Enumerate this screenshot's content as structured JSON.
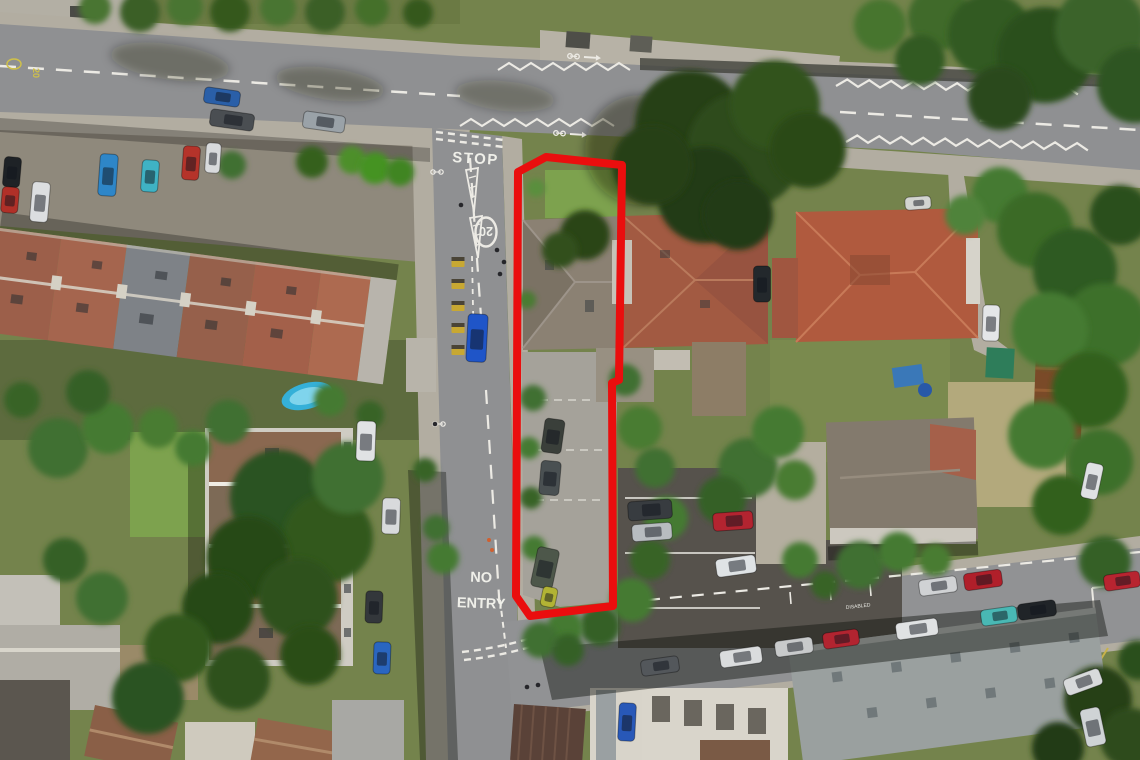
{
  "image": {
    "type": "aerial-drone-photo",
    "description": "Aerial view of a residential junction with a long narrow property plot outlined in red, containing a semi-detached house and rear parking area"
  },
  "boundary": {
    "label": "property-boundary",
    "color": "#ea0e0e",
    "stroke_width": 8,
    "points": "518,172 546,157 622,165 619,380 612,383 613,606 530,616 516,596"
  },
  "road_markings": {
    "stop": "STOP",
    "speed_limit": "20",
    "speed_limit_yellow": "20",
    "no_entry_line1": "NO",
    "no_entry_line2": "ENTRY",
    "disabled_bay": "DISABLED"
  },
  "palette": {
    "road": "#8f9092",
    "pavement": "#b2ada1",
    "grass": "#74834c",
    "dry_grass": "#b3a97c",
    "tree_dark": "#253f16",
    "tree_light": "#4a7c33",
    "roof_red": "#a25a42",
    "roof_grey": "#8b8173",
    "car_park_asphalt": "#56524c",
    "boundary_red": "#ea0e0e"
  },
  "trees": [
    [
      95,
      8,
      16,
      "#4a7530"
    ],
    [
      140,
      12,
      20,
      "#3a5f25"
    ],
    [
      185,
      7,
      18,
      "#4a7530"
    ],
    [
      230,
      12,
      20,
      "#35591f"
    ],
    [
      278,
      8,
      18,
      "#4a7530"
    ],
    [
      325,
      12,
      20,
      "#3a5f25"
    ],
    [
      372,
      9,
      17,
      "#44702c"
    ],
    [
      418,
      13,
      15,
      "#35591f"
    ],
    [
      232,
      165,
      14,
      "#3f7030"
    ],
    [
      312,
      162,
      16,
      "#35601f"
    ],
    [
      352,
      160,
      14,
      "#4d8f2a"
    ],
    [
      375,
      168,
      16,
      "#459323"
    ],
    [
      400,
      172,
      14,
      "#3f8524"
    ],
    [
      690,
      168,
      14,
      "#4a7c33"
    ],
    [
      718,
      172,
      15,
      "#3f7030"
    ],
    [
      748,
      174,
      13,
      "#447a32"
    ],
    [
      690,
      125,
      55,
      "#253f16"
    ],
    [
      745,
      150,
      58,
      "#2d4c1a"
    ],
    [
      705,
      195,
      48,
      "#223a14"
    ],
    [
      775,
      105,
      45,
      "#32531e"
    ],
    [
      652,
      165,
      40,
      "#253f16"
    ],
    [
      808,
      150,
      38,
      "#2b4819"
    ],
    [
      738,
      215,
      35,
      "#223a14"
    ],
    [
      940,
      18,
      32,
      "#3f6b2b"
    ],
    [
      990,
      35,
      42,
      "#335a22"
    ],
    [
      1045,
      55,
      48,
      "#2c4f1c"
    ],
    [
      1100,
      30,
      45,
      "#3a6329"
    ],
    [
      1135,
      85,
      38,
      "#2f5520"
    ],
    [
      880,
      25,
      26,
      "#47742f"
    ],
    [
      1000,
      98,
      32,
      "#2b4a1d"
    ],
    [
      920,
      60,
      25,
      "#335a22"
    ],
    [
      1000,
      195,
      28,
      "#447a32"
    ],
    [
      1035,
      230,
      38,
      "#3a6b28"
    ],
    [
      1075,
      270,
      42,
      "#2f5a20"
    ],
    [
      1105,
      325,
      42,
      "#3c7029"
    ],
    [
      1050,
      330,
      38,
      "#447a32"
    ],
    [
      1090,
      390,
      38,
      "#32601f"
    ],
    [
      1042,
      435,
      34,
      "#447a32"
    ],
    [
      1100,
      462,
      33,
      "#3c7029"
    ],
    [
      1062,
      505,
      30,
      "#32601f"
    ],
    [
      1120,
      215,
      30,
      "#2c4f1c"
    ],
    [
      965,
      215,
      20,
      "#50833a"
    ],
    [
      533,
      398,
      13,
      "#3f7030"
    ],
    [
      529,
      448,
      11,
      "#447a32"
    ],
    [
      531,
      498,
      11,
      "#386328"
    ],
    [
      534,
      548,
      12,
      "#447a32"
    ],
    [
      527,
      300,
      9,
      "#4a7c33"
    ],
    [
      536,
      188,
      9,
      "#5a8f3c"
    ],
    [
      585,
      235,
      25,
      "#2c4418"
    ],
    [
      560,
      250,
      18,
      "#334f1c"
    ],
    [
      640,
      428,
      22,
      "#4a7c33"
    ],
    [
      655,
      468,
      20,
      "#3f7030"
    ],
    [
      666,
      518,
      22,
      "#447a32"
    ],
    [
      650,
      560,
      20,
      "#386328"
    ],
    [
      632,
      600,
      22,
      "#447a32"
    ],
    [
      600,
      626,
      20,
      "#356026"
    ],
    [
      565,
      628,
      18,
      "#447a32"
    ],
    [
      625,
      380,
      16,
      "#3f7030"
    ],
    [
      748,
      468,
      30,
      "#3f7030"
    ],
    [
      778,
      432,
      26,
      "#447a32"
    ],
    [
      722,
      500,
      24,
      "#356026"
    ],
    [
      795,
      480,
      20,
      "#4a7c33"
    ],
    [
      58,
      448,
      30,
      "#3f7030"
    ],
    [
      108,
      428,
      26,
      "#447a32"
    ],
    [
      88,
      392,
      22,
      "#356026"
    ],
    [
      158,
      428,
      20,
      "#4a7c33"
    ],
    [
      228,
      422,
      22,
      "#3f7030"
    ],
    [
      193,
      448,
      18,
      "#447a32"
    ],
    [
      22,
      400,
      18,
      "#386328"
    ],
    [
      330,
      400,
      16,
      "#447a32"
    ],
    [
      370,
      415,
      14,
      "#386328"
    ],
    [
      278,
      498,
      48,
      "#2c5220"
    ],
    [
      328,
      538,
      45,
      "#30591f"
    ],
    [
      248,
      558,
      42,
      "#284a17"
    ],
    [
      298,
      598,
      40,
      "#2e511c"
    ],
    [
      348,
      478,
      36,
      "#3f7030"
    ],
    [
      218,
      608,
      36,
      "#284a17"
    ],
    [
      178,
      648,
      34,
      "#30591f"
    ],
    [
      148,
      698,
      36,
      "#2c5220"
    ],
    [
      238,
      678,
      32,
      "#2e511c"
    ],
    [
      102,
      598,
      26,
      "#3f7030"
    ],
    [
      65,
      560,
      22,
      "#356026"
    ],
    [
      310,
      655,
      30,
      "#2a4d18"
    ],
    [
      443,
      558,
      16,
      "#447a32"
    ],
    [
      436,
      528,
      13,
      "#3f7030"
    ],
    [
      540,
      640,
      18,
      "#3f7030"
    ],
    [
      568,
      650,
      16,
      "#356026"
    ],
    [
      425,
      470,
      12,
      "#386328"
    ],
    [
      860,
      565,
      24,
      "#3f7030"
    ],
    [
      898,
      552,
      20,
      "#447a32"
    ],
    [
      1105,
      562,
      26,
      "#356026"
    ],
    [
      935,
      560,
      16,
      "#4a7c33"
    ],
    [
      1098,
      700,
      34,
      "#253f16"
    ],
    [
      1130,
      738,
      30,
      "#2d4c1a"
    ],
    [
      1058,
      748,
      26,
      "#223a14"
    ],
    [
      1138,
      660,
      20,
      "#2c4f1c"
    ],
    [
      800,
      560,
      18,
      "#447a32"
    ],
    [
      825,
      585,
      14,
      "#386328"
    ]
  ],
  "cars": [
    [
      12,
      172,
      17,
      30,
      5,
      "#1e2226"
    ],
    [
      10,
      200,
      17,
      26,
      5,
      "#b03028"
    ],
    [
      40,
      202,
      18,
      40,
      5,
      "#dcdee0"
    ],
    [
      108,
      175,
      18,
      42,
      4,
      "#2e86c8"
    ],
    [
      150,
      176,
      17,
      32,
      4,
      "#3fb2c4"
    ],
    [
      191,
      163,
      17,
      34,
      4,
      "#b5332a"
    ],
    [
      213,
      158,
      15,
      30,
      4,
      "#d8dadc"
    ],
    [
      222,
      97,
      36,
      16,
      8,
      "#2a5fa8"
    ],
    [
      232,
      120,
      44,
      17,
      8,
      "#4a4e52"
    ],
    [
      324,
      122,
      42,
      17,
      8,
      "#9aa2a8"
    ],
    [
      477,
      338,
      20,
      48,
      3,
      "#1f55c8"
    ],
    [
      553,
      436,
      20,
      34,
      8,
      "#3a3f3a"
    ],
    [
      550,
      478,
      20,
      34,
      5,
      "#4a5052"
    ],
    [
      545,
      568,
      22,
      40,
      12,
      "#4d574a"
    ],
    [
      549,
      597,
      15,
      20,
      12,
      "#b2b334"
    ],
    [
      650,
      510,
      44,
      19,
      -4,
      "#383c40"
    ],
    [
      652,
      532,
      40,
      17,
      -4,
      "#b8bcc0"
    ],
    [
      733,
      521,
      40,
      18,
      -4,
      "#b32430"
    ],
    [
      736,
      566,
      40,
      18,
      -8,
      "#dfe3e5"
    ],
    [
      938,
      586,
      38,
      16,
      -8,
      "#d0d2d4"
    ],
    [
      983,
      580,
      38,
      17,
      -8,
      "#b01f2a"
    ],
    [
      999,
      616,
      36,
      16,
      -8,
      "#49b8b4"
    ],
    [
      1037,
      610,
      38,
      16,
      -8,
      "#202428"
    ],
    [
      660,
      666,
      38,
      16,
      -8,
      "#53575b"
    ],
    [
      741,
      657,
      42,
      17,
      -8,
      "#dadcdd"
    ],
    [
      794,
      647,
      38,
      16,
      -8,
      "#c8cacb"
    ],
    [
      841,
      639,
      36,
      16,
      -8,
      "#b22430"
    ],
    [
      917,
      629,
      42,
      17,
      -8,
      "#e0e2e3"
    ],
    [
      1083,
      682,
      38,
      17,
      -20,
      "#d8dadb"
    ],
    [
      1093,
      727,
      20,
      38,
      -12,
      "#cfd3d5"
    ],
    [
      627,
      722,
      17,
      38,
      3,
      "#2858b8"
    ],
    [
      366,
      441,
      19,
      40,
      2,
      "#e0e2e4"
    ],
    [
      391,
      516,
      18,
      36,
      2,
      "#d8dadc"
    ],
    [
      374,
      607,
      17,
      32,
      2,
      "#33373b"
    ],
    [
      382,
      658,
      17,
      32,
      2,
      "#2a66c0"
    ],
    [
      991,
      323,
      17,
      36,
      2,
      "#e4e6e8"
    ],
    [
      1092,
      481,
      17,
      36,
      12,
      "#dfe1e3"
    ],
    [
      1122,
      581,
      36,
      16,
      -8,
      "#b82430"
    ],
    [
      918,
      203,
      26,
      13,
      -4,
      "#d2d4d0"
    ],
    [
      762,
      284,
      17,
      36,
      0,
      "#23282c"
    ]
  ],
  "bike_bays": [
    [
      458,
      262
    ],
    [
      458,
      284
    ],
    [
      458,
      306
    ],
    [
      458,
      328
    ],
    [
      458,
      350
    ]
  ],
  "pedestrians": [
    [
      497,
      250
    ],
    [
      504,
      262
    ],
    [
      500,
      274
    ],
    [
      527,
      687
    ],
    [
      538,
      685
    ],
    [
      461,
      205
    ],
    [
      435,
      424
    ]
  ]
}
